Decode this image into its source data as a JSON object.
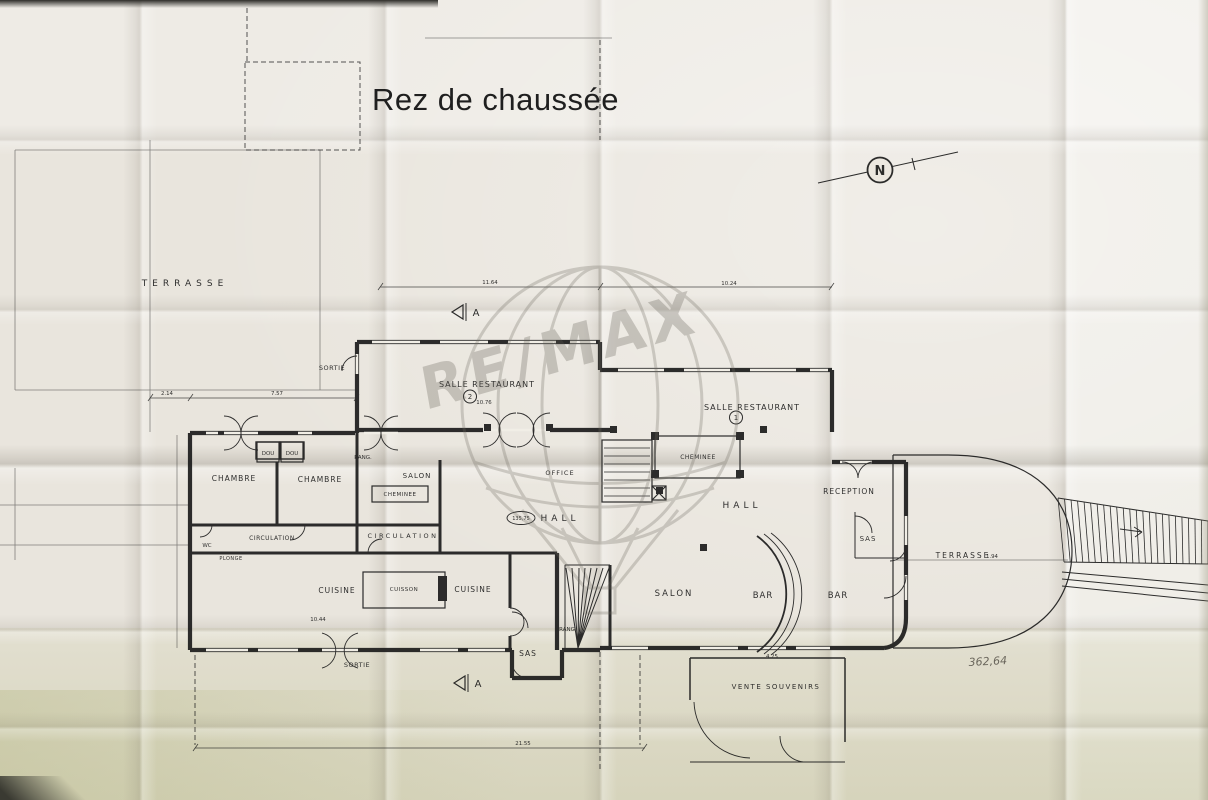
{
  "meta": {
    "title": "Rez de chaussée",
    "watermark_text": "RE/MAX",
    "north_label": "N",
    "handwritten_note": "362,64"
  },
  "plan": {
    "ink": "#1c1c1c",
    "paper": "#e9e5dd",
    "rooms": [
      {
        "name": "terrasse-left",
        "text": "TERRASSE",
        "x": 185,
        "y": 286,
        "fs": 9,
        "ls": 5
      },
      {
        "name": "sortie-upper",
        "text": "SORTIE",
        "x": 332,
        "y": 370,
        "fs": 6.5,
        "ls": 0.5
      },
      {
        "name": "salle-restaurant-2",
        "text": "SALLE   RESTAURANT",
        "x": 487,
        "y": 387,
        "fs": 8,
        "ls": 1
      },
      {
        "name": "salle-restaurant-1",
        "text": "SALLE  RESTAURANT",
        "x": 752,
        "y": 410,
        "fs": 8,
        "ls": 1
      },
      {
        "name": "chambre-1",
        "text": "CHAMBRE",
        "x": 234,
        "y": 481,
        "fs": 7.5,
        "ls": 1
      },
      {
        "name": "chambre-2",
        "text": "CHAMBRE",
        "x": 320,
        "y": 482,
        "fs": 7.5,
        "ls": 1
      },
      {
        "name": "dou-1",
        "text": "DOU",
        "x": 268,
        "y": 455,
        "fs": 5.5,
        "ls": 0,
        "boxed": true
      },
      {
        "name": "dou-2",
        "text": "DOU",
        "x": 292,
        "y": 455,
        "fs": 5.5,
        "ls": 0,
        "boxed": true
      },
      {
        "name": "rang-upper",
        "text": "RANG.",
        "x": 363,
        "y": 459,
        "fs": 5.5,
        "ls": 0
      },
      {
        "name": "salon-left",
        "text": "SALON",
        "x": 417,
        "y": 478,
        "fs": 7,
        "ls": 1
      },
      {
        "name": "cheminee-left",
        "text": "CHEMINEE",
        "x": 400,
        "y": 496,
        "fs": 5.5,
        "ls": 0.5
      },
      {
        "name": "office",
        "text": "OFFICE",
        "x": 560,
        "y": 475,
        "fs": 6.5,
        "ls": 1
      },
      {
        "name": "cheminee-right",
        "text": "CHEMINEE",
        "x": 698,
        "y": 459,
        "fs": 6,
        "ls": 0.5
      },
      {
        "name": "wc",
        "text": "WC",
        "x": 207,
        "y": 547,
        "fs": 5.5,
        "ls": 0
      },
      {
        "name": "circulation-left",
        "text": "CIRCULATION",
        "x": 272,
        "y": 540,
        "fs": 6,
        "ls": 0.5
      },
      {
        "name": "circulation-right",
        "text": "CIRCULATION",
        "x": 403,
        "y": 538,
        "fs": 6.5,
        "ls": 2.5
      },
      {
        "name": "plonge",
        "text": "PLONGE",
        "x": 231,
        "y": 560,
        "fs": 5,
        "ls": 0.5
      },
      {
        "name": "cuisine-left",
        "text": "CUISINE",
        "x": 337,
        "y": 593,
        "fs": 7.5,
        "ls": 1
      },
      {
        "name": "cuisson",
        "text": "CUISSON",
        "x": 404,
        "y": 591,
        "fs": 5.5,
        "ls": 0.5
      },
      {
        "name": "cuisine-right",
        "text": "CUISINE",
        "x": 473,
        "y": 592,
        "fs": 7.5,
        "ls": 1
      },
      {
        "name": "sortie-lower",
        "text": "SORTIE",
        "x": 357,
        "y": 667,
        "fs": 6.5,
        "ls": 0.5
      },
      {
        "name": "sas-stairs",
        "text": "SAS",
        "x": 528,
        "y": 656,
        "fs": 7.5,
        "ls": 1
      },
      {
        "name": "rang-stairs",
        "text": "RANG",
        "x": 567,
        "y": 631,
        "fs": 5.5,
        "ls": 0
      },
      {
        "name": "hall-center",
        "text": "HALL",
        "x": 560,
        "y": 521,
        "fs": 9,
        "ls": 4
      },
      {
        "name": "hall-right",
        "text": "HALL",
        "x": 742,
        "y": 508,
        "fs": 9,
        "ls": 4
      },
      {
        "name": "salon-bar",
        "text": "SALON",
        "x": 674,
        "y": 596,
        "fs": 8.5,
        "ls": 2
      },
      {
        "name": "bar-left",
        "text": "BAR",
        "x": 763,
        "y": 598,
        "fs": 8.5,
        "ls": 1
      },
      {
        "name": "bar-right",
        "text": "BAR",
        "x": 838,
        "y": 598,
        "fs": 8.5,
        "ls": 1
      },
      {
        "name": "reception",
        "text": "RECEPTION",
        "x": 849,
        "y": 494,
        "fs": 7.5,
        "ls": 1
      },
      {
        "name": "sas-right",
        "text": "SAS",
        "x": 868,
        "y": 541,
        "fs": 7,
        "ls": 1
      },
      {
        "name": "terrasse-right",
        "text": "TERRASSE",
        "x": 963,
        "y": 558,
        "fs": 7.5,
        "ls": 2
      },
      {
        "name": "vente-souvenirs",
        "text": "VENTE  SOUVENIRS",
        "x": 776,
        "y": 689,
        "fs": 7,
        "ls": 1.5
      }
    ],
    "badges": [
      {
        "name": "restaurant-2-number",
        "text": "2",
        "x": 470,
        "y": 399
      },
      {
        "name": "restaurant-1-number",
        "text": "1",
        "x": 736,
        "y": 420
      }
    ],
    "level_markers": [
      {
        "name": "hall-level",
        "text": "135,75",
        "x": 521,
        "y": 520
      }
    ],
    "dimensions": [
      {
        "text": "2.14",
        "x": 167,
        "y": 395
      },
      {
        "text": "7.57",
        "x": 277,
        "y": 395
      },
      {
        "text": "11.64",
        "x": 490,
        "y": 284
      },
      {
        "text": "10.24",
        "x": 729,
        "y": 285
      },
      {
        "text": "10.76",
        "x": 484,
        "y": 404
      },
      {
        "text": "10.44",
        "x": 318,
        "y": 621
      },
      {
        "text": "21.55",
        "x": 523,
        "y": 745
      },
      {
        "text": "4.25",
        "x": 772,
        "y": 658
      },
      {
        "text": "1.94",
        "x": 992,
        "y": 558
      }
    ],
    "section_markers": [
      {
        "label": "A",
        "x": 468,
        "y": 312
      },
      {
        "label": "A",
        "x": 470,
        "y": 683
      }
    ]
  }
}
